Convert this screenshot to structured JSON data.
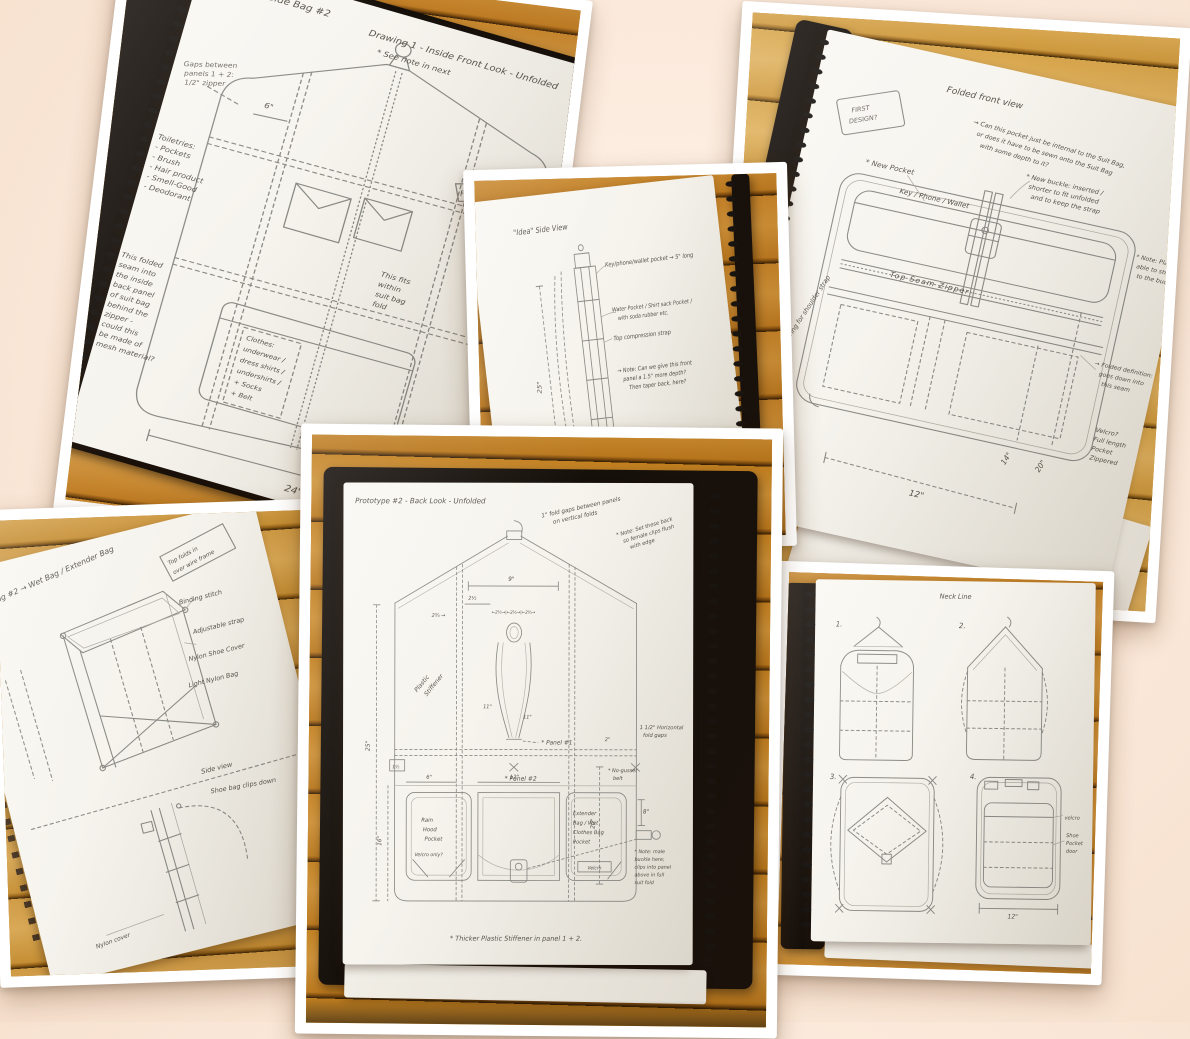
{
  "page1": {
    "title": "Side Bag #2",
    "heading": "Drawing 1 - Inside Front Look - Unfolded",
    "see_note": "* See note in next",
    "gap_note": [
      "Gaps between",
      "panels 1 + 2:",
      "1/2\" zipper"
    ],
    "toiletries": [
      "Toiletries:",
      "- Pockets",
      "- Brush",
      "- Hair product",
      "- Smell-Good",
      "- Deodorant"
    ],
    "seam_note": [
      "This folded",
      "seam into",
      "the inside",
      "back panel",
      "of suit bag",
      "behind the",
      "zipper -",
      "could this",
      "be made of",
      "mesh material?"
    ],
    "clothes": [
      "Clothes:",
      "underwear /",
      "dress shirts /",
      "undershirts /",
      "+ Socks",
      "+ Belt"
    ],
    "fits_note": [
      "This fits",
      "within",
      "suit bag",
      "fold"
    ],
    "fold_tag": "FOLD LINE",
    "fold_line_label": "Fold Line",
    "dim_24": "24\"",
    "dim_6": "6\""
  },
  "page2": {
    "title": "\"Idea\" Side View",
    "key_pocket": "Key/phone/wallet pocket → 5\" long",
    "water_pocket": [
      "Water Pocket / Shirt sack Pocket /",
      "with soda rubber etc."
    ],
    "top_strap": "Top compression strap",
    "depth_note": [
      "→ Note: Can we give this front",
      "panel a 1.5\" more depth?",
      "Then taper back, here?"
    ],
    "bottom_strap": "→ New bottom compression strap",
    "dim_25": "25\""
  },
  "page3": {
    "title": "Folded front view",
    "stamp": [
      "FIRST",
      "DESIGN?"
    ],
    "internal_note": [
      "→ Can this pocket just be internal to the Suit Bag,",
      "or does it have to be sewn onto the Suit Bag",
      "with some depth to it?"
    ],
    "new_pocket": "* New Pocket",
    "kpw_label": "Key / Phone / Wallet",
    "buckle_note": [
      "* New buckle: inserted /",
      "shorter to fit unfolded",
      "and to keep the strap"
    ],
    "bars_note": [
      "* Note: Place bars",
      "able to strap Velcro",
      "to the buckle"
    ],
    "seam_zipper": "Top Seam Zipper",
    "folded_note": [
      "→ Folded definition:",
      "goes down into",
      "this seam"
    ],
    "full_length": [
      "Velcro?",
      "Full length",
      "Pocket",
      "Zippered"
    ],
    "dring": "D-ring for shoulder strap",
    "dim_14": "14\"",
    "dim_20": "20\"",
    "dim_12": "12\"",
    "corner_note": [
      "For folds →",
      "T. Stand"
    ]
  },
  "page4": {
    "title": "Prototype #2 - Back Look - Unfolded",
    "gap_note": [
      "1\" fold gaps between panels",
      "on vertical folds"
    ],
    "setback_note": [
      "* Note: Set these back",
      "so female clips flush",
      "with edge"
    ],
    "hfold_note": [
      "1 1/2\" Horizontal",
      "fold gaps"
    ],
    "stiffener": [
      "Plastic",
      "Stiffener"
    ],
    "panel1": "* Panel #1",
    "panel2": "* Panel #2",
    "rain_pocket": [
      "Rain",
      "Hood",
      "Pocket"
    ],
    "velcro_only": "Velcro only?",
    "extender_pocket": [
      "Extender",
      "Bag / Wet",
      "Clothes Bag",
      "Pocket"
    ],
    "velcro_tag": "Velcro",
    "male_buckle_note": [
      "* Note: male",
      "buckle here;",
      "clips into panel",
      "above in full",
      "suit fold"
    ],
    "no_gusset": [
      "* No-gusset",
      "belt"
    ],
    "footer": "* Thicker Plastic Stiffener in panel 1 + 2.",
    "dim_25": "25\"",
    "dim_16": "16\"",
    "dim_20": "20\"",
    "dim_9": "9\"",
    "dim_2h": "2½",
    "dim_2q": "2¾ →",
    "dim_chain": "←2½→|←2½→|←2¾→",
    "dim_11a": "11\"",
    "dim_11b": "11\"",
    "dim_8": "8\"",
    "dim_6": "6\"",
    "dim_12": "12\"",
    "dim_2": "2\"",
    "clip_tag": "1½"
  },
  "page5": {
    "title": "Drawing #2 → Wet Bag / Extender Bag",
    "tag_note": [
      "Top folds in",
      "over wire frame"
    ],
    "binding": "Binding stitch",
    "adjustable": "Adjustable strap",
    "shoe_cover": "Nylon Shoe Cover",
    "light_bag": "Light Nylon Bag",
    "side_view": "Side view",
    "clips_down": "Shoe bag clips down",
    "nylon_cover": "Nylon cover"
  },
  "page6": {
    "header": "Neck Line",
    "num1": "1.",
    "num2": "2.",
    "num3": "3.",
    "num4": "4.",
    "velcro": "velcro",
    "shoe_door": [
      "Shoe",
      "Pocket",
      "door"
    ],
    "dim_12": "12\""
  }
}
